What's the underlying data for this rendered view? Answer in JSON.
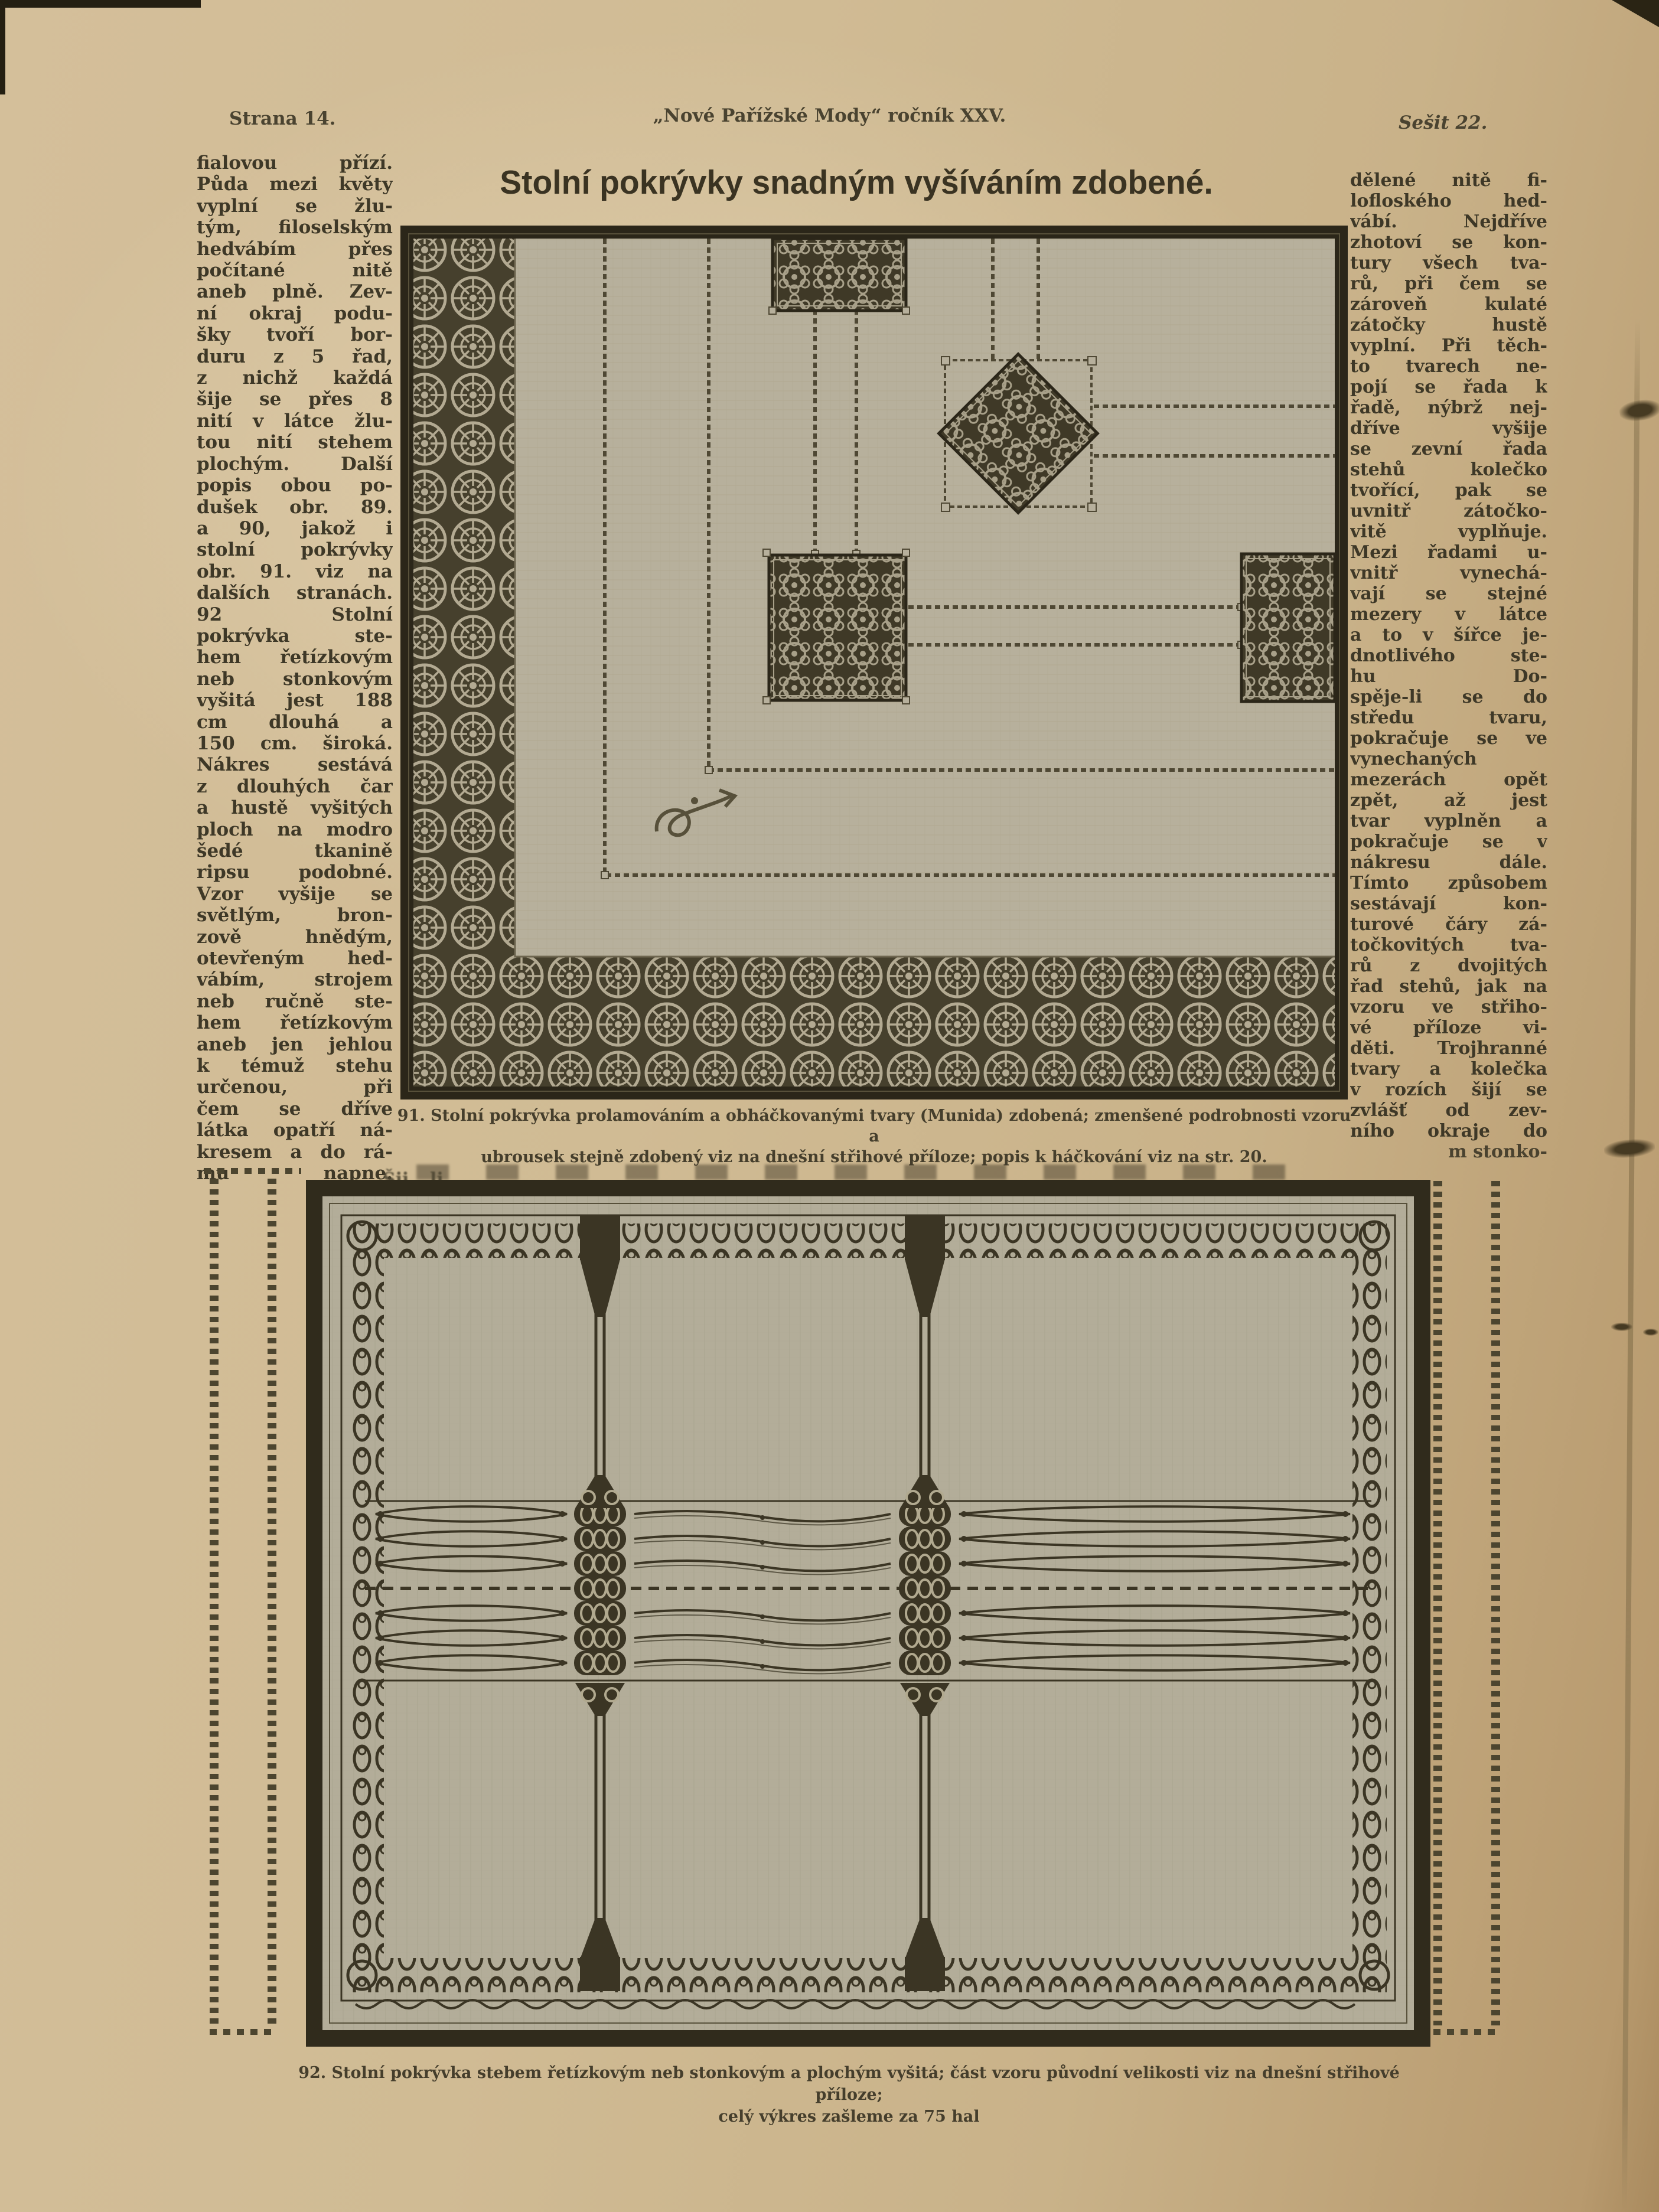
{
  "header": {
    "page_label": "Strana 14.",
    "journal": "„Nové Pařížské Mody“ ročník XXV.",
    "issue_label": "Sešit 22."
  },
  "title": "Stolní pokrývky snadným vyšíváním zdobené.",
  "columns": {
    "left_lines": [
      "fialovou přízí.",
      "Půda mezi květy",
      "vyplní se žlu-",
      "tým, filoselským",
      "hedvábím přes",
      "počítané nitě",
      "aneb plně. Zev-",
      "ní okraj podu-",
      "šky tvoří bor-",
      "duru z 5 řad,",
      "z nichž každá",
      "šije se přes 8",
      "nití v látce žlu-",
      "tou nití stehem",
      "plochým. Další",
      "popis obou po-",
      "dušek obr. 89.",
      "a 90, jakož i",
      "stolní pokrývky",
      "obr. 91. viz na",
      "dalších stranách.",
      "92 Stolní",
      "pokrývka ste-",
      "hem řetízkovým",
      "neb stonkovým",
      "vyšitá jest 188",
      "cm dlouhá a",
      "150 cm. široká.",
      "Nákres sestává",
      "z dlouhých čar",
      "a hustě vyšitých",
      "ploch na modro",
      "šedé tkanině",
      "ripsu podobné.",
      "Vzor vyšije se",
      "světlým, bron-",
      "zově hnědým,",
      "otevřeným hed-",
      "vábím, strojem",
      "neb ručně ste-",
      "hem řetízkovým",
      "aneb jen jehlou",
      "k témuž stehu",
      "určenou, při",
      "čem se dříve",
      "látka opatří ná-",
      "kresem a do rá-",
      "mu napne."
    ],
    "right_lines": [
      "dělené nitě fi-",
      "lofloského hed-",
      "vábí. Nejdříve",
      "zhotoví se kon-",
      "tury všech tva-",
      "rů, při čem se",
      "zároveň kulaté",
      "zátočky hustě",
      "vyplní. Při těch-",
      "to tvarech ne-",
      "pojí se řada k",
      "řadě, nýbrž nej-",
      "dříve vyšije",
      "se zevní řada",
      "stehů kolečko",
      "tvořící, pak se",
      "uvnitř zátočko-",
      "vitě vyplňuje.",
      "Mezi řadami u-",
      "vnitř vynechá-",
      "vají se stejné",
      "mezery v látce",
      "a to v šířce je-",
      "dnotlivého ste-",
      "hu Do-",
      "spěje-li se do",
      "středu tvaru,",
      "pokračuje se ve",
      "vynechaných",
      "mezerách opět",
      "zpět, až jest",
      "tvar vyplněn a",
      "pokračuje se v",
      "nákresu dále.",
      "Tímto způsobem",
      "sestávají kon-",
      "turové čáry zá-",
      "točkovitých tva-",
      "rů z dvojitých",
      "řad stehů, jak na",
      "vzoru ve střiho-",
      "vé příloze vi-",
      "děti. Trojhranné",
      "tvary a kolečka",
      "v rozích šijí se",
      "zvlášť od zev-",
      "ního okraje do",
      "m stonko-"
    ]
  },
  "figures": {
    "fig91": {
      "caption_lines": [
        "91. Stolní pokrývka prolamováním a obháčkovanými tvary (Munida) zdobená; zmenšené podrobnosti vzoru a",
        "ubrousek stejně zdobený viz na dnešní střihové příloze; popis k háčkování viz na str. 20."
      ]
    },
    "fig92": {
      "caption_lines": [
        "92. Stolní pokrývka stebem řetízkovým neb stonkovým a plochým vyšitá; část vzoru původní velikosti viz na dnešní střihové příloze;",
        "celý výkres zašleme za 75 hal"
      ]
    }
  },
  "fragments": {
    "a": "Šij",
    "b": "li"
  },
  "colors": {
    "paper": "#cfb98f",
    "ink": "#3e3827",
    "fabric": "#b6af9b",
    "lace_dark": "#46402d",
    "lace_light": "#b3aa92"
  }
}
